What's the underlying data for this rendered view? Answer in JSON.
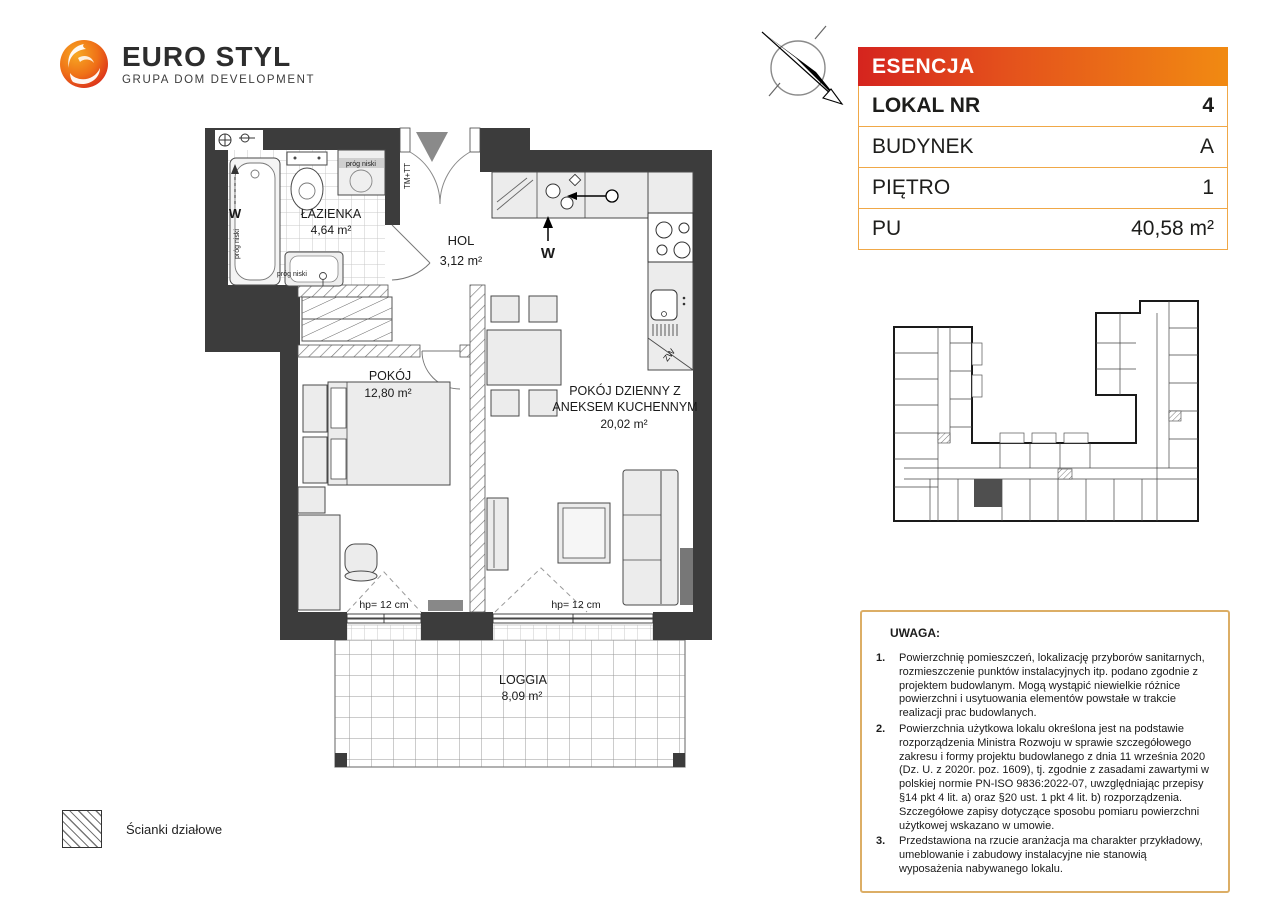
{
  "logo": {
    "brand": "EURO STYL",
    "tagline": "GRUPA DOM DEVELOPMENT"
  },
  "panel": {
    "project": "ESENCJA",
    "accent_red": "#d5241e",
    "accent_orange": "#f18a12",
    "border_orange": "#f0a848",
    "rows": [
      {
        "label": "LOKAL NR",
        "value": "4"
      },
      {
        "label": "BUDYNEK",
        "value": "A"
      },
      {
        "label": "PIĘTRO",
        "value": "1"
      },
      {
        "label": "PU",
        "value": "40,58 m²"
      }
    ]
  },
  "notes": {
    "title": "UWAGA:",
    "items": [
      {
        "n": "1.",
        "text": "Powierzchnię pomieszczeń, lokalizację przyborów sanitarnych, rozmieszczenie punktów instalacyjnych itp. podano zgodnie z projektem budowlanym. Mogą wystąpić niewielkie różnice powierzchni i usytuowania elementów powstałe w trakcie realizacji prac budowlanych."
      },
      {
        "n": "2.",
        "text": "Powierzchnia użytkowa lokalu określona jest na podstawie rozporządzenia Ministra Rozwoju w sprawie szczegółowego zakresu i formy projektu budowlanego z dnia 11 września 2020 (Dz. U. z 2020r. poz. 1609), tj. zgodnie z zasadami zawartymi w polskiej normie PN-ISO 9836:2022-07, uwzględniając przepisy §14 pkt 4 lit. a) oraz §20 ust. 1 pkt 4 lit. b) rozporządzenia. Szczegółowe zapisy dotyczące sposobu pomiaru powierzchni użytkowej wskazano w umowie."
      },
      {
        "n": "3.",
        "text": "Przedstawiona na rzucie aranżacja ma charakter przykładowy, umeblowanie i zabudowy instalacyjne nie stanowią wyposażenia nabywanego lokalu."
      }
    ]
  },
  "legend": {
    "label": "Ścianki działowe"
  },
  "floorplan": {
    "rooms": {
      "lazienka": {
        "name": "ŁAZIENKA",
        "area": "4,64 m²"
      },
      "hol": {
        "name": "HOL",
        "area": "3,12 m²"
      },
      "pokoj": {
        "name": "POKÓJ",
        "area": "12,80 m²"
      },
      "dzienny": {
        "line1": "POKÓJ DZIENNY Z",
        "line2": "ANEKSEM KUCHENNYM",
        "area": "20,02 m²"
      },
      "loggia": {
        "name": "LOGGIA",
        "area": "8,09 m²"
      }
    },
    "annotations": {
      "hp_left": "hp= 12 cm",
      "hp_right": "hp= 12 cm",
      "prog_top": "próg niski",
      "prog_side": "próg niski",
      "prog_bottom": "próg niski",
      "tm_tt": "TM+TT",
      "vent_bath": "W",
      "vent_kitchen": "W",
      "zw": "ZW"
    }
  }
}
